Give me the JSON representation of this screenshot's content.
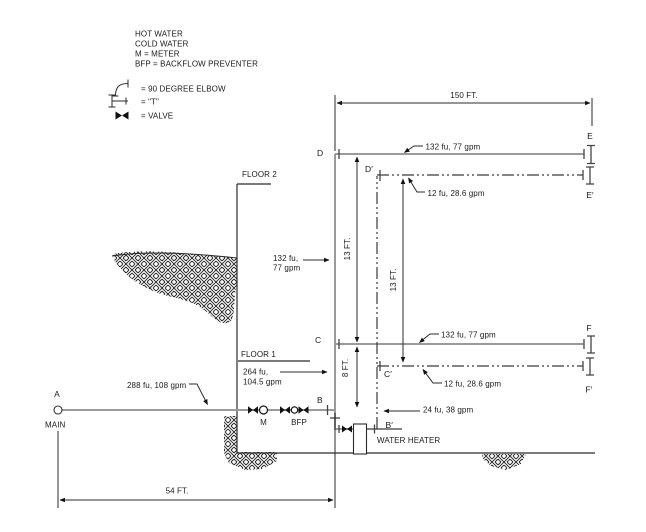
{
  "legend": {
    "items": [
      "HOT WATER",
      "COLD WATER",
      "M = METER",
      "BFP = BACKFLOW PREVENTER"
    ],
    "symbols": [
      {
        "icon": "elbow",
        "label": "= 90 DEGREE ELBOW"
      },
      {
        "icon": "tee",
        "label": "= \"T\""
      },
      {
        "icon": "valve",
        "label": "= VALVE"
      }
    ]
  },
  "floors": {
    "floor2": "FLOOR 2",
    "floor1": "FLOOR 1"
  },
  "nodes": {
    "a": "A",
    "b": "B",
    "c": "C",
    "d": "D",
    "e": "E",
    "f": "F",
    "b_p": "B′",
    "c_p": "C′",
    "d_p": "D′",
    "e_p": "E′",
    "f_p": "F′"
  },
  "labels": {
    "main": "MAIN",
    "meter": "M",
    "bfp": "BFP",
    "water_heater": "WATER HEATER"
  },
  "dimensions": {
    "run_150": "150 FT.",
    "run_54": "54 FT.",
    "floor2_height": "13 FT.",
    "hot_riser_height": "13 FT.",
    "floor1_height": "8 FT."
  },
  "flows": {
    "service": "288 fu, 108 gpm",
    "riser_lower_line1": "264 fu,",
    "riser_lower_line2": "104.5 gpm",
    "riser_upper_line1": "132 fu,",
    "riser_upper_line2": "77 gpm",
    "floor2_cold": "132 fu, 77 gpm",
    "floor2_hot": "12 fu, 28.6 gpm",
    "floor1_cold": "132 fu, 77 gpm",
    "floor1_hot": "12 fu, 28.6 gpm",
    "water_heater_branch": "24 fu, 38 gpm"
  },
  "colors": {
    "cold_pipe": "#9a9a9a",
    "hot_pipe": "#3a3a3a",
    "line": "#2b2b2b",
    "text": "#1a1a1a",
    "background": "#ffffff"
  }
}
